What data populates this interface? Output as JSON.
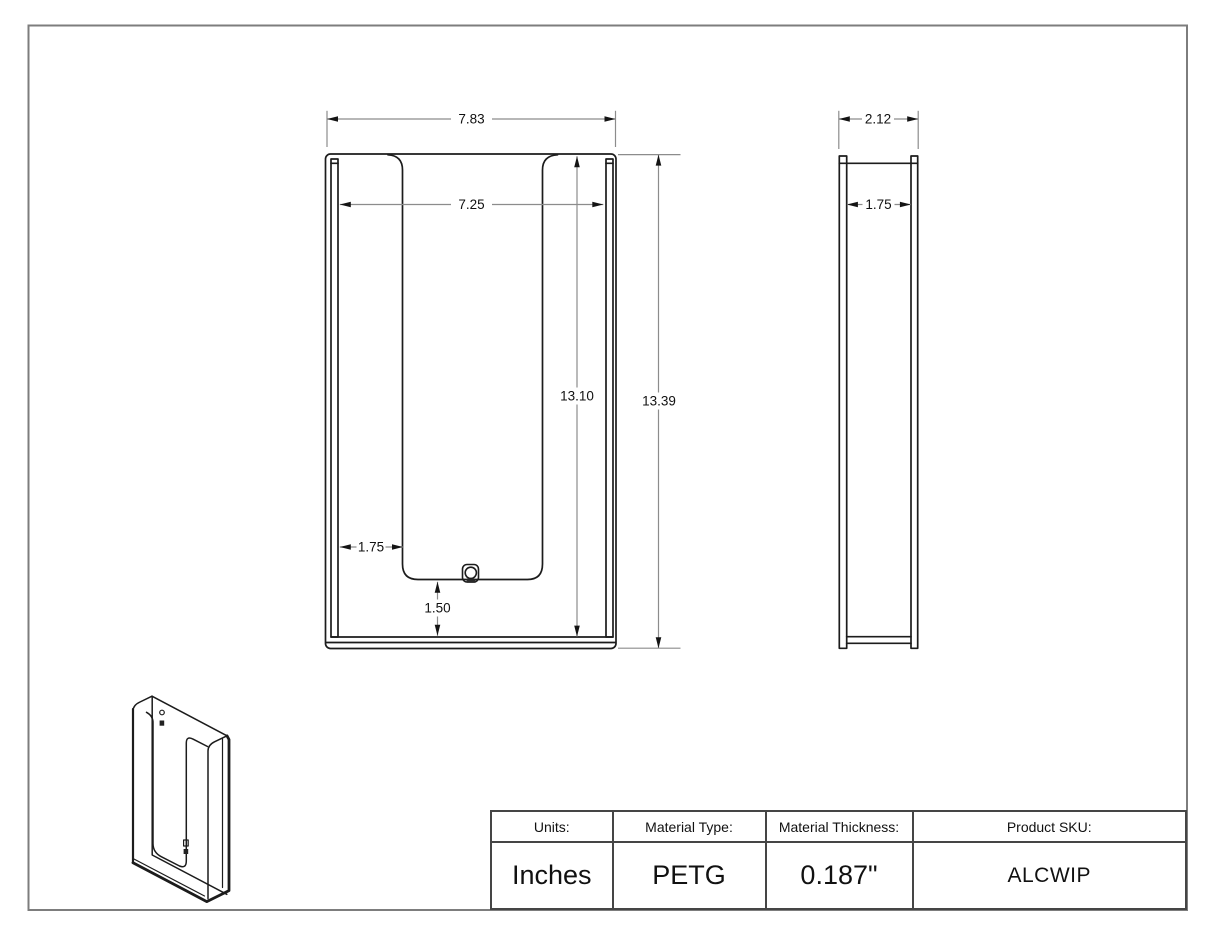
{
  "drawing": {
    "front_view": {
      "outer_width": "7.83",
      "inner_width": "7.25",
      "inner_height": "13.10",
      "outer_height": "13.39",
      "side_inset": "1.75",
      "bottom_inset": "1.50"
    },
    "side_view": {
      "outer_depth": "2.12",
      "inner_depth": "1.75"
    }
  },
  "title_block": {
    "columns": [
      {
        "header": "Units:",
        "value": "Inches"
      },
      {
        "header": "Material Type:",
        "value": "PETG"
      },
      {
        "header": "Material Thickness:",
        "value": "0.187\""
      },
      {
        "header": "Product SKU:",
        "value": "ALCWIP"
      }
    ]
  },
  "colors": {
    "geometry_line": "#1c1c1c",
    "dimension_line": "#8c8c8c",
    "page_border": "#7d7d7d",
    "table_border": "#454545"
  }
}
